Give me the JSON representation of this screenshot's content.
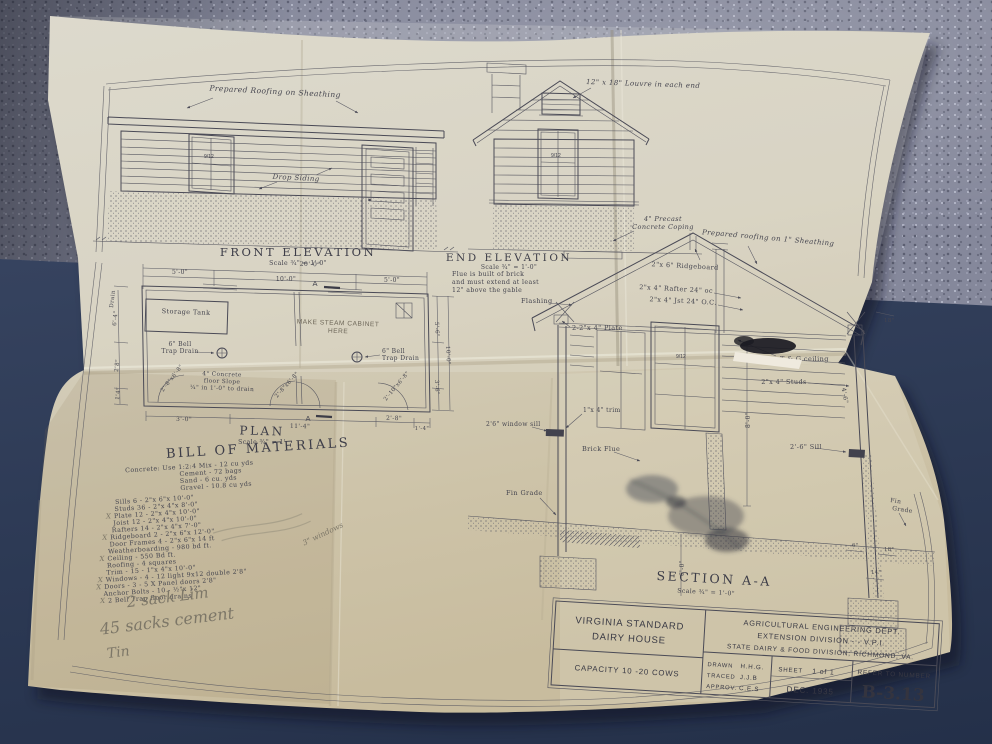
{
  "sheet": {
    "front_elevation": {
      "caption": "FRONT ELEVATION",
      "scale": "Scale ¾\" = 1'-0\"",
      "roofing_note": "Prepared Roofing on Sheathing",
      "siding_note": "Drop Siding",
      "window_lights": "9/12"
    },
    "end_elevation": {
      "caption": "END ELEVATION",
      "scale": "Scale ¾\" = 1'-0\"",
      "louvre_note": "12\" x 18\" Louvre in each end",
      "coping_note_line1": "4\" Precast",
      "coping_note_line2": "Concrete Coping",
      "flue_note_line1": "Flue is built of brick",
      "flue_note_line2": "and must extend at least",
      "flue_note_line3": "12\" above the gable",
      "flashing_label": "Flashing",
      "window_lights": "9/12"
    },
    "plan": {
      "caption": "PLAN",
      "scale": "Scale ¾\" = 1'",
      "room_label": "Storage Tank",
      "pencil_note_line1": "MAKE STEAM CABINET",
      "pencil_note_line2": "HERE",
      "drain_left_line1": "6\" Bell",
      "drain_left_line2": "Trap Drain",
      "drain_right_line1": "6\" Bell",
      "drain_right_line2": "Trap Drain",
      "floor_note_line1": "4\" Concrete",
      "floor_note_line2": "floor Slope",
      "floor_note_line3": "¼\" in 1'-0\" to drain",
      "section_marker_top": "A",
      "section_marker_bottom": "A",
      "dims": {
        "overall_top": "20'-0\"",
        "top_left": "5'-0\"",
        "top_mid": "10'-0\"",
        "top_right": "5'-0\"",
        "left_drain": "Drain",
        "left_a": "6'-4\"",
        "left_b": "2'8\"",
        "left_c": "1'4\"",
        "right_a": "5'-6\"",
        "right_overall": "10'-0\"",
        "right_b": "3'-6\"",
        "bottom_a": "3'-0\"",
        "bottom_b": "11'-4\"",
        "bottom_c": "2'-8\"",
        "bottom_d": "1'-4\"",
        "door_left": "2'-8\"x6'-8\"",
        "door_mid": "2'-8\"x6'-8\"",
        "door_right": "2'-10\"x6'-8\""
      }
    },
    "section": {
      "caption": "SECTION A-A",
      "scale": "Scale ¾\" = 1'-0\"",
      "roofing_note": "Prepared roofing on 1\" Sheathing",
      "ridge_note": "2\"x 6\" Ridgeboard",
      "rafter_note": "2\"x 4\" Rafter 24\" oc",
      "joist_note": "2\"x 4\" Jst 24\" O.C.",
      "plate_note": "2-2\"x 4\" Plate",
      "ceiling_note": "T & G ceiling",
      "stud_note": "2\"x 4\" Studs",
      "sill_note": "2'-6\" Sill",
      "window_sill_note": "2'6\" window sill",
      "trim_note": "1\"x 4\" trim",
      "flue_label": "Brick Flue",
      "grade_left": "Fin Grade",
      "grade_right_line1": "Fin",
      "grade_right_line2": "Grade",
      "window_lights": "9/12",
      "dims": {
        "wall_height": "8'-0\"",
        "depth": "6'-0\"",
        "stud_len": "4'-6\"",
        "eave": "18\"",
        "footing_stem": "6\"",
        "footing_w": "18\"",
        "footing_h": "14\""
      }
    },
    "bill_of_materials": {
      "title": "BILL OF MATERIALS",
      "items": [
        {
          "text": "Concrete: Use 1:2:4 Mix - 12 cu yds",
          "mark": ""
        },
        {
          "text": "Cement - 72 bags",
          "mark": ""
        },
        {
          "text": "Sand - 6 cu. yds",
          "mark": ""
        },
        {
          "text": "Gravel - 10.8 cu yds",
          "mark": ""
        },
        {
          "text": "Sills 6 - 2\"x 6\"x 10'-0\"",
          "mark": ""
        },
        {
          "text": "Studs 36 - 2\"x 4\"x 8'-0\"",
          "mark": ""
        },
        {
          "text": "Plate 12 - 2\"x 4\"x 10'-0\"",
          "mark": "X"
        },
        {
          "text": "Joist 12 - 2\"x 4\"x 10'-0\"",
          "mark": ""
        },
        {
          "text": "Rafters 14 - 2\"x 4\"x 7'-0\"",
          "mark": ""
        },
        {
          "text": "Ridgeboard 2 - 2\"x 6\"x 12'-0\"",
          "mark": "X"
        },
        {
          "text": "Door Frames 4 - 2\"x 6\"x 14 ft",
          "mark": ""
        },
        {
          "text": "Weatherboarding - 980 bd ft.",
          "mark": ""
        },
        {
          "text": "Ceiling - 550 Bd ft.",
          "mark": "X"
        },
        {
          "text": "Roofing - 4 squares",
          "mark": ""
        },
        {
          "text": "Trim - 15 - 1\"x 4\"x 10'-0\"",
          "mark": ""
        },
        {
          "text": "Windows - 4 - 12 light 9x12 double 2'8\"",
          "mark": "X"
        },
        {
          "text": "Doors - 3 - 5 X Panel doors 2'8\"",
          "mark": "X"
        },
        {
          "text": "Anchor Bolts - 10 - ½\"x 12\"",
          "mark": ""
        },
        {
          "text": "2 Bell Trap floor drains",
          "mark": "X"
        }
      ],
      "pencil_side_note": "3\" windows"
    },
    "pencil_notes": {
      "line1": "2 sack Lim",
      "line2": "45 sacks cement",
      "line3": "Tin"
    },
    "title_block": {
      "project_line1": "VIRGINIA STANDARD",
      "project_line2": "DAIRY HOUSE",
      "capacity": "CAPACITY 10 -20 COWS",
      "org_line1": "AGRICULTURAL ENGINEERING DEPT.",
      "org_line2": "EXTENSION DIVISION - - V.P.I.",
      "org_line3": "STATE DAIRY & FOOD DIVISION; RICHMOND, VA.",
      "drawn_label": "DRAWN",
      "drawn_value": "H.H.G.",
      "traced_label": "TRACED",
      "traced_value": "J.J.B",
      "approved_label": "APPROV.",
      "approved_value": "C.E.S",
      "sheet_label": "SHEET",
      "sheet_value": "1 of 1",
      "date": "DEC. 1935",
      "refer_label": "REFER TO NUMBER",
      "number": "B-3.13"
    }
  }
}
